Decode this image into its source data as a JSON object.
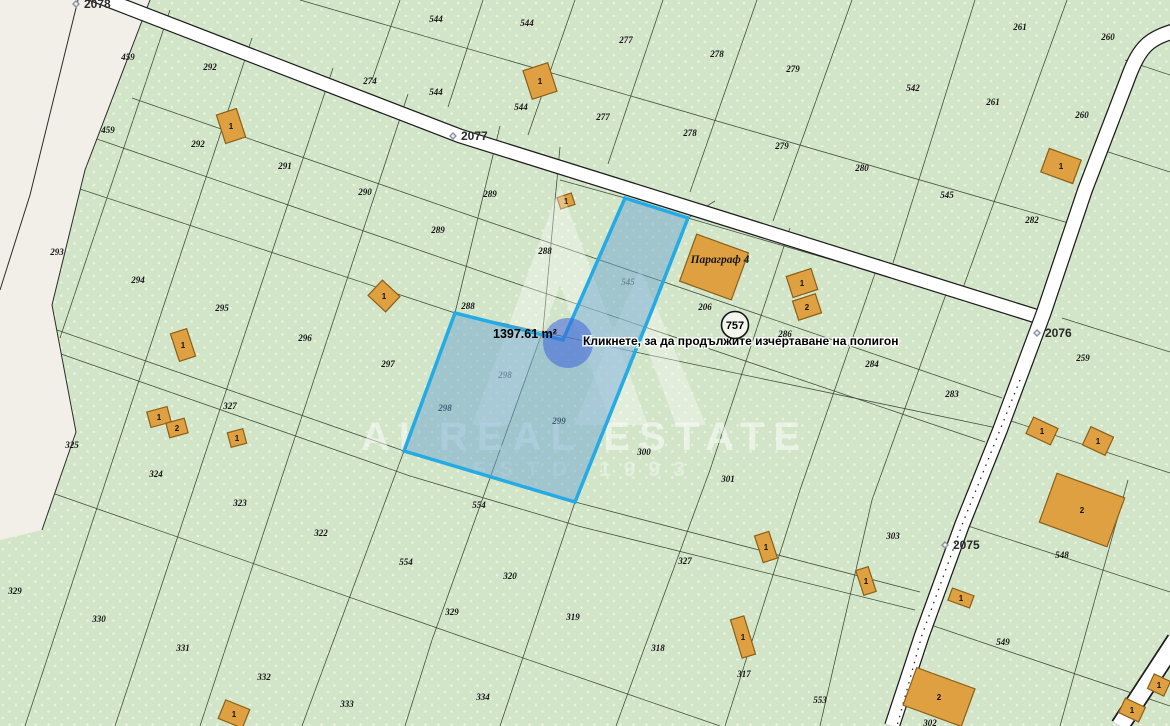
{
  "map": {
    "colors": {
      "parcel_green": "#d3e5c9",
      "parcel_dot": "#e8f3df",
      "boundary_line": "#33402e",
      "road_white": "#ffffff",
      "road_shoulder_beige": "#f2efe8",
      "building_fill": "#dfa042",
      "building_stroke": "#8a5f17",
      "selection_fill": "rgba(110,165,210,0.5)",
      "selection_stroke": "#24aae4",
      "cursor_fill": "rgba(62,98,218,0.55)"
    },
    "selection": {
      "area_label": "1397.61 m²",
      "tooltip": "Кликнете, за да продължите изчертаване на полигон"
    },
    "route_badge": "757",
    "poi_label": "Параграф 4",
    "watermark": {
      "line1": "AI REAL ESTATE",
      "line2": "ESTD 1993"
    },
    "road_labels": [
      {
        "text": "2078",
        "x": 89,
        "y": 8
      },
      {
        "text": "2077",
        "x": 466,
        "y": 140
      },
      {
        "text": "2076",
        "x": 1050,
        "y": 337
      },
      {
        "text": "2075",
        "x": 958,
        "y": 549
      }
    ],
    "parcel_labels": [
      {
        "t": "459",
        "x": 128,
        "y": 60
      },
      {
        "t": "292",
        "x": 210,
        "y": 70
      },
      {
        "t": "274",
        "x": 370,
        "y": 84
      },
      {
        "t": "544",
        "x": 436,
        "y": 22
      },
      {
        "t": "544",
        "x": 527,
        "y": 26
      },
      {
        "t": "277",
        "x": 626,
        "y": 43
      },
      {
        "t": "278",
        "x": 717,
        "y": 57
      },
      {
        "t": "261",
        "x": 1020,
        "y": 30
      },
      {
        "t": "260",
        "x": 1108,
        "y": 40
      },
      {
        "t": "459",
        "x": 108,
        "y": 133
      },
      {
        "t": "292",
        "x": 198,
        "y": 147
      },
      {
        "t": "291",
        "x": 285,
        "y": 169
      },
      {
        "t": "290",
        "x": 365,
        "y": 195
      },
      {
        "t": "289",
        "x": 490,
        "y": 197
      },
      {
        "t": "289",
        "x": 438,
        "y": 233
      },
      {
        "t": "288",
        "x": 545,
        "y": 254
      },
      {
        "t": "288",
        "x": 468,
        "y": 309
      },
      {
        "t": "279",
        "x": 793,
        "y": 72
      },
      {
        "t": "279",
        "x": 782,
        "y": 149
      },
      {
        "t": "542",
        "x": 913,
        "y": 91
      },
      {
        "t": "261",
        "x": 993,
        "y": 105
      },
      {
        "t": "260",
        "x": 1082,
        "y": 118
      },
      {
        "t": "280",
        "x": 862,
        "y": 171
      },
      {
        "t": "545",
        "x": 947,
        "y": 198
      },
      {
        "t": "282",
        "x": 1032,
        "y": 223
      },
      {
        "t": "544",
        "x": 436,
        "y": 95
      },
      {
        "t": "544",
        "x": 521,
        "y": 110
      },
      {
        "t": "277",
        "x": 603,
        "y": 120
      },
      {
        "t": "278",
        "x": 690,
        "y": 136
      },
      {
        "t": "545",
        "x": 628,
        "y": 285,
        "f": true
      },
      {
        "t": "206",
        "x": 705,
        "y": 310
      },
      {
        "t": "286",
        "x": 785,
        "y": 337
      },
      {
        "t": "284",
        "x": 872,
        "y": 367
      },
      {
        "t": "283",
        "x": 952,
        "y": 397
      },
      {
        "t": "259",
        "x": 1083,
        "y": 361
      },
      {
        "t": "293",
        "x": 57,
        "y": 255
      },
      {
        "t": "294",
        "x": 138,
        "y": 283
      },
      {
        "t": "295",
        "x": 222,
        "y": 311
      },
      {
        "t": "296",
        "x": 305,
        "y": 341
      },
      {
        "t": "297",
        "x": 388,
        "y": 367
      },
      {
        "t": "298",
        "x": 505,
        "y": 378,
        "f": true
      },
      {
        "t": "298",
        "x": 445,
        "y": 411
      },
      {
        "t": "299",
        "x": 559,
        "y": 424
      },
      {
        "t": "300",
        "x": 644,
        "y": 455
      },
      {
        "t": "301",
        "x": 728,
        "y": 482
      },
      {
        "t": "327",
        "x": 230,
        "y": 409
      },
      {
        "t": "327",
        "x": 685,
        "y": 564
      },
      {
        "t": "325",
        "x": 72,
        "y": 448
      },
      {
        "t": "324",
        "x": 156,
        "y": 477
      },
      {
        "t": "323",
        "x": 240,
        "y": 506
      },
      {
        "t": "322",
        "x": 321,
        "y": 536
      },
      {
        "t": "554",
        "x": 479,
        "y": 508
      },
      {
        "t": "554",
        "x": 406,
        "y": 565
      },
      {
        "t": "320",
        "x": 510,
        "y": 579
      },
      {
        "t": "329",
        "x": 452,
        "y": 615
      },
      {
        "t": "319",
        "x": 573,
        "y": 620
      },
      {
        "t": "318",
        "x": 658,
        "y": 651
      },
      {
        "t": "317",
        "x": 744,
        "y": 677
      },
      {
        "t": "553",
        "x": 820,
        "y": 703
      },
      {
        "t": "329",
        "x": 15,
        "y": 594
      },
      {
        "t": "330",
        "x": 99,
        "y": 622
      },
      {
        "t": "331",
        "x": 183,
        "y": 651
      },
      {
        "t": "332",
        "x": 264,
        "y": 680
      },
      {
        "t": "333",
        "x": 347,
        "y": 707
      },
      {
        "t": "334",
        "x": 483,
        "y": 700
      },
      {
        "t": "303",
        "x": 893,
        "y": 539
      },
      {
        "t": "548",
        "x": 1062,
        "y": 558
      },
      {
        "t": "549",
        "x": 1003,
        "y": 645
      },
      {
        "t": "302",
        "x": 930,
        "y": 726
      }
    ],
    "buildings": [
      {
        "x": 231,
        "y": 126,
        "w": 21,
        "h": 30,
        "r": -18,
        "n": "1"
      },
      {
        "x": 540,
        "y": 81,
        "w": 26,
        "h": 30,
        "r": -18,
        "n": "1"
      },
      {
        "x": 566,
        "y": 201,
        "w": 15,
        "h": 12,
        "r": -18,
        "n": "1"
      },
      {
        "x": 714,
        "y": 267,
        "w": 55,
        "h": 50,
        "r": 20,
        "n": ""
      },
      {
        "x": 802,
        "y": 283,
        "w": 26,
        "h": 22,
        "r": -18,
        "n": "1"
      },
      {
        "x": 807,
        "y": 307,
        "w": 24,
        "h": 20,
        "r": -18,
        "n": "2"
      },
      {
        "x": 1061,
        "y": 166,
        "w": 34,
        "h": 25,
        "r": 20,
        "n": "1"
      },
      {
        "x": 183,
        "y": 345,
        "w": 17,
        "h": 29,
        "r": -18,
        "n": "1"
      },
      {
        "x": 159,
        "y": 417,
        "w": 21,
        "h": 16,
        "r": -15,
        "n": "1"
      },
      {
        "x": 177,
        "y": 428,
        "w": 19,
        "h": 15,
        "r": -15,
        "n": "2"
      },
      {
        "x": 237,
        "y": 438,
        "w": 16,
        "h": 15,
        "r": -15,
        "n": "1"
      },
      {
        "x": 384,
        "y": 296,
        "w": 24,
        "h": 21,
        "r": 43,
        "n": "1"
      },
      {
        "x": 766,
        "y": 547,
        "w": 15,
        "h": 28,
        "r": -18,
        "n": "1"
      },
      {
        "x": 866,
        "y": 581,
        "w": 13,
        "h": 26,
        "r": -18,
        "n": "1"
      },
      {
        "x": 1042,
        "y": 431,
        "w": 27,
        "h": 18,
        "r": 25,
        "n": "1"
      },
      {
        "x": 1098,
        "y": 441,
        "w": 25,
        "h": 20,
        "r": 25,
        "n": "1"
      },
      {
        "x": 1082,
        "y": 510,
        "w": 72,
        "h": 52,
        "r": 20,
        "n": "2"
      },
      {
        "x": 961,
        "y": 598,
        "w": 23,
        "h": 13,
        "r": 20,
        "n": "1"
      },
      {
        "x": 939,
        "y": 697,
        "w": 62,
        "h": 40,
        "r": 20,
        "n": "2"
      },
      {
        "x": 1159,
        "y": 685,
        "w": 18,
        "h": 16,
        "r": 25,
        "n": "1"
      },
      {
        "x": 1132,
        "y": 710,
        "w": 22,
        "h": 16,
        "r": 25,
        "n": "1"
      },
      {
        "x": 743,
        "y": 637,
        "w": 14,
        "h": 40,
        "r": -17,
        "n": "1"
      },
      {
        "x": 234,
        "y": 714,
        "w": 26,
        "h": 20,
        "r": 22,
        "n": "1"
      }
    ]
  }
}
